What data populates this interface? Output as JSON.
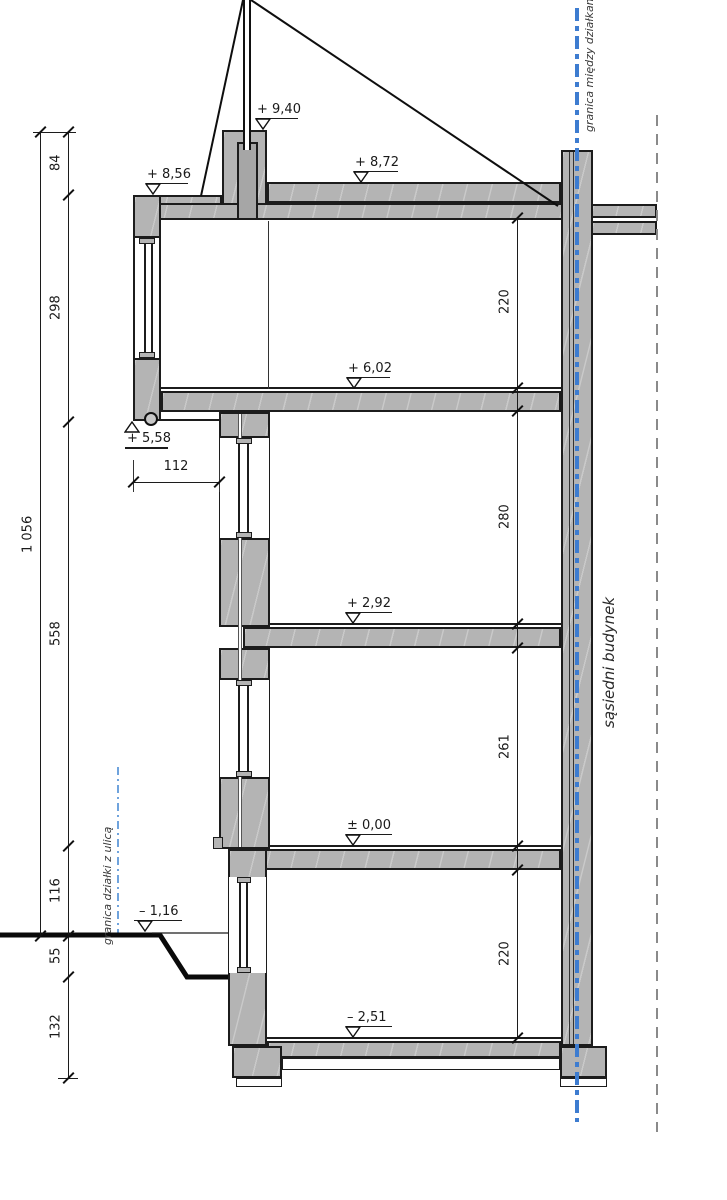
{
  "drawing": {
    "labels": {
      "boundary_between_plots": "granica między działkami",
      "boundary_street": "granica działki z ulicą",
      "neighbor_building": "sąsiedni budynek"
    },
    "elevations": [
      "+ 9,40",
      "+ 8,72",
      "+ 8,56",
      "+ 6,02",
      "+ 5,58",
      "+ 2,92",
      "± 0,00",
      "– 1,16",
      "– 2,51"
    ],
    "dimensions": {
      "total_height": "1 056",
      "left_chain": [
        "84",
        "298",
        "558",
        "116",
        "55",
        "132"
      ],
      "interior_heights": [
        "220",
        "280",
        "261",
        "220"
      ],
      "overhang": "112"
    },
    "colors": {
      "wall_fill": "#b4b4b4",
      "outline": "#1c1c1c",
      "boundary_blue": "#3d7cd0",
      "dashed_gray": "#8a8a8a"
    }
  }
}
